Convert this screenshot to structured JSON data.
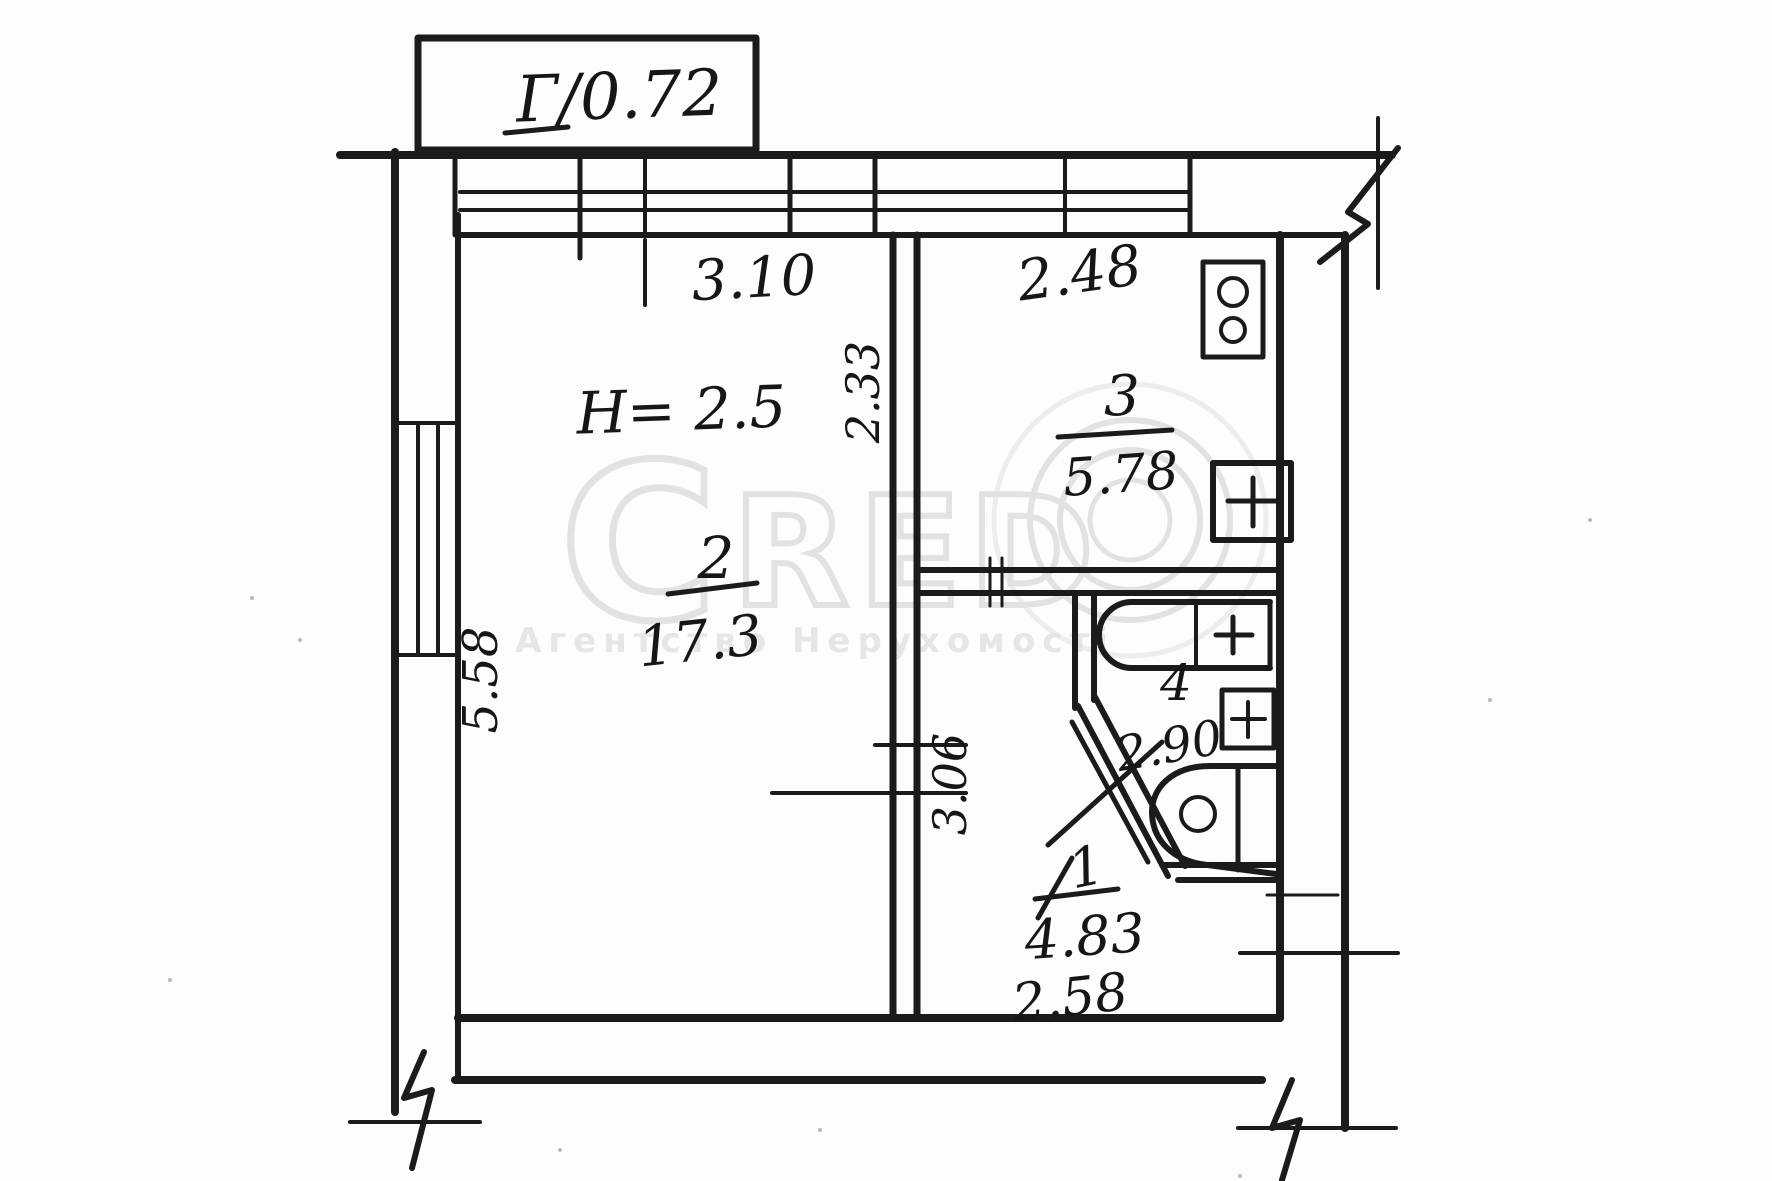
{
  "plan": {
    "balcony_label": "Г/0.72",
    "ceiling_height_note": "H= 2.5",
    "rooms": {
      "living": {
        "number": "2",
        "area": "17.3"
      },
      "kitchen": {
        "number": "3",
        "area": "5.78"
      },
      "bathroom": {
        "number": "4",
        "area": "2.90"
      },
      "hall": {
        "number": "1",
        "area": "4.83"
      }
    },
    "dimensions": {
      "living_width": "3.10",
      "kitchen_width": "2.48",
      "kitchen_depth": "2.33",
      "living_depth": "5.58",
      "hall_depth": "3.06",
      "hall_width": "2.58"
    },
    "fixtures": [
      "stove",
      "kitchen-sink",
      "bathtub",
      "washbasin",
      "toilet"
    ],
    "ink_color": "#1b1b1b"
  },
  "watermark": {
    "letters": [
      "C",
      "R",
      "E",
      "D"
    ],
    "subtitle": "Агентство Нерухомості",
    "color": "#cccccc"
  }
}
